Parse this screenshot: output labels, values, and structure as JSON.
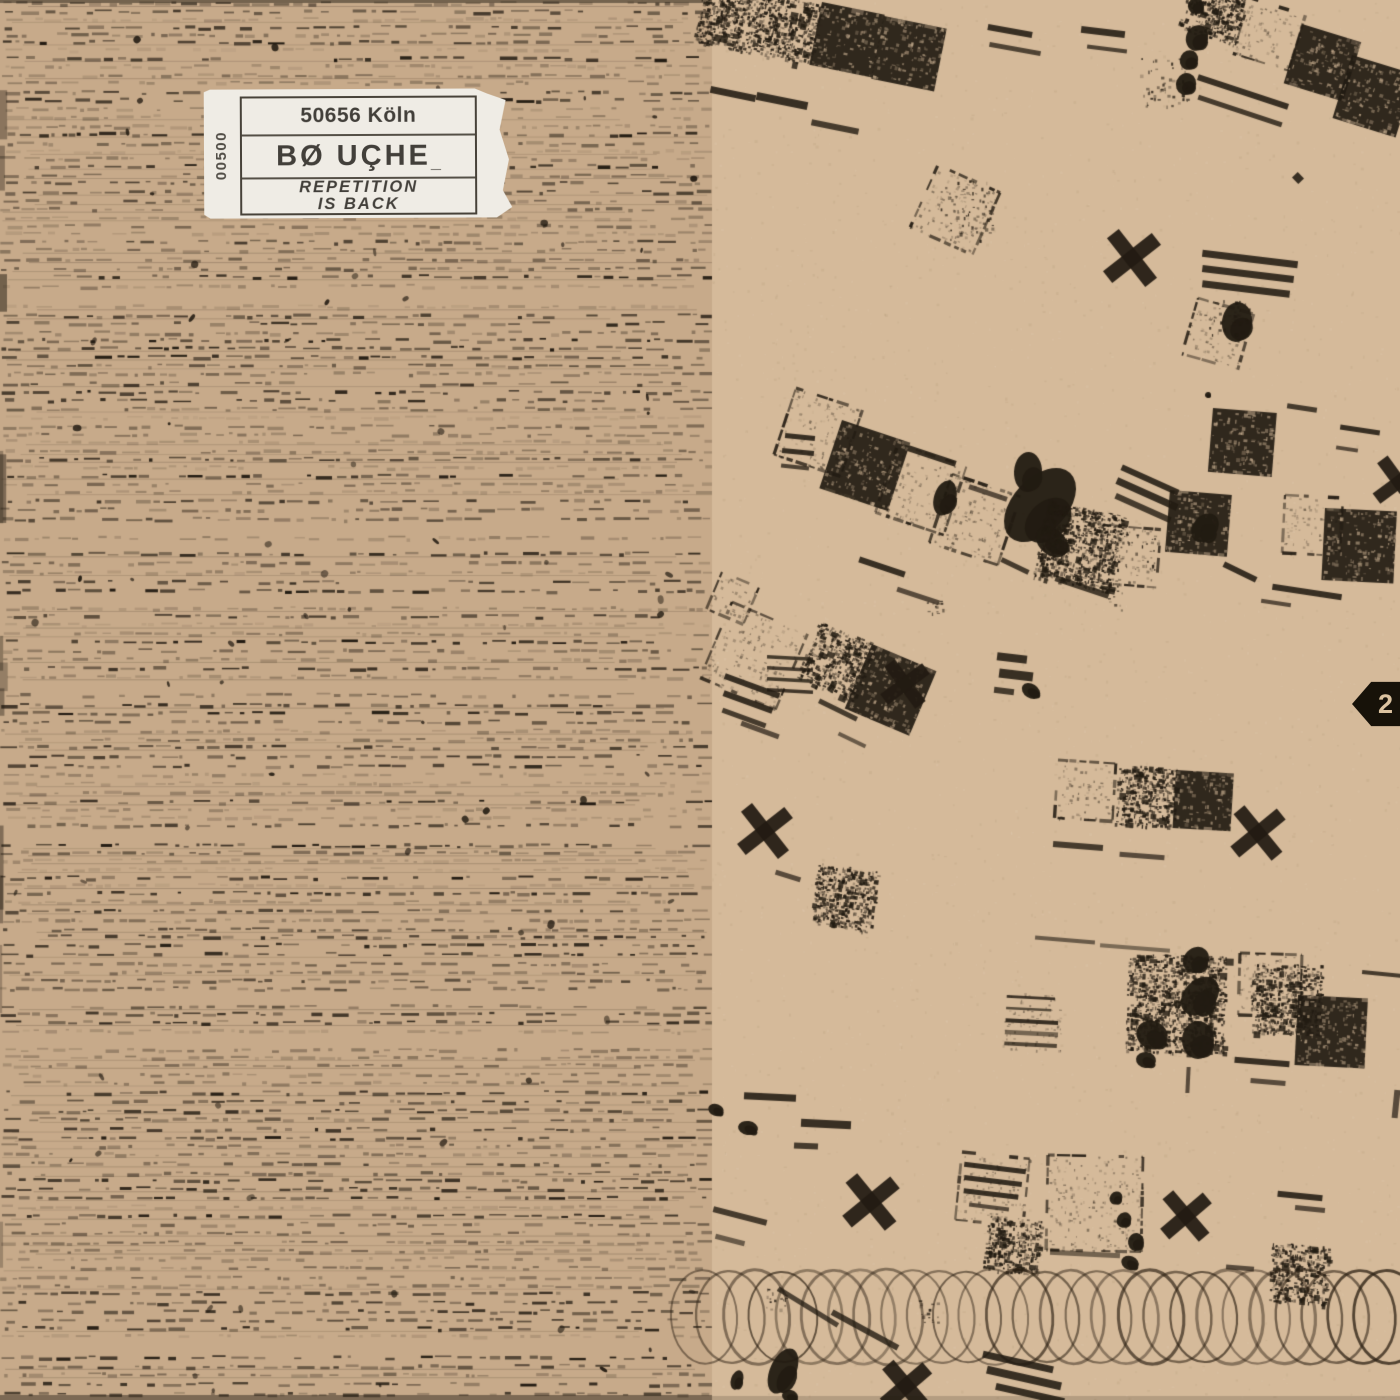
{
  "artwork": {
    "sticker": {
      "line1": "50656 Köln",
      "line2": "BØ UÇHE",
      "line2_mark": "_",
      "line3a": "REPETITION",
      "line3b": "IS BACK",
      "edition": "00500"
    },
    "side_marker": "2",
    "motifs": [
      "typed-text-texture",
      "stamped-film-squares",
      "x-stamps",
      "ink-blots",
      "coil-spiral-band",
      "hatch-marks"
    ]
  },
  "colors": {
    "paper_left": "#c7aa8a",
    "paper_right": "#d5ba9a",
    "ink": "#221b12",
    "sticker_bg": "#efece5",
    "sticker_ink": "#34312c",
    "marker_bg": "#171209",
    "marker_text": "#dcc3a0"
  }
}
